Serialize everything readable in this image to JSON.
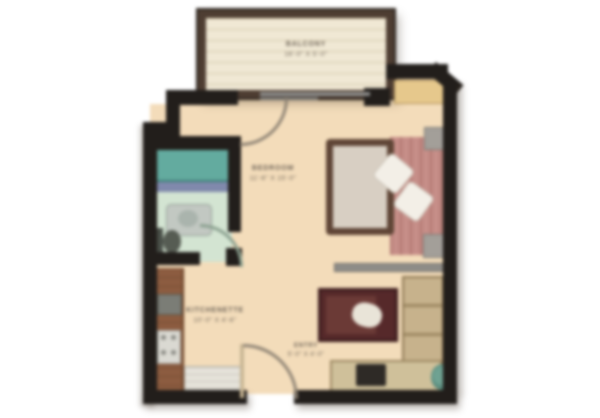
{
  "plan": {
    "rooms": {
      "balcony": {
        "name": "BALCONY",
        "dims": "16'-0\" X 5'-0\""
      },
      "bedroom": {
        "name": "BEDROOM",
        "dims": "11'-6\" X 15'-0\""
      },
      "kitchenette": {
        "name": "KITCHENETTE",
        "dims": "10'-0\" X 4'-6\""
      },
      "entry": {
        "name": "ENTRY",
        "dims": "5'-0\" X 4'-0\""
      }
    },
    "fixtures": [
      "bathtub",
      "tile-strip",
      "vanity-sink",
      "toilet",
      "bed",
      "duvet",
      "pillow",
      "nightstand",
      "coffee-table",
      "tv-console",
      "tv",
      "shelving-unit",
      "plant",
      "kitchen-counter",
      "microwave",
      "stove",
      "refrigerator",
      "sliding-glass-door",
      "door-swing-arc",
      "wall",
      "shelf-ledge"
    ],
    "palette": {
      "floor_main": "#f3dcba",
      "floor_balcony": "#f0e8d4",
      "floor_bath": "#d3e4d2",
      "wall_black": "#221e1b",
      "wall_balcony_brown": "#4e3d32",
      "bathtub_teal": "#63ab9f",
      "tile_blue": "#8089ac",
      "bed_linen_pink": "#c68e88",
      "bed_frame_brown": "#5f4536",
      "table_maroon": "#56292a",
      "cabinet_tan": "#c7b28c",
      "counter_wood": "#8c5c40",
      "background": "#ffffff"
    }
  }
}
